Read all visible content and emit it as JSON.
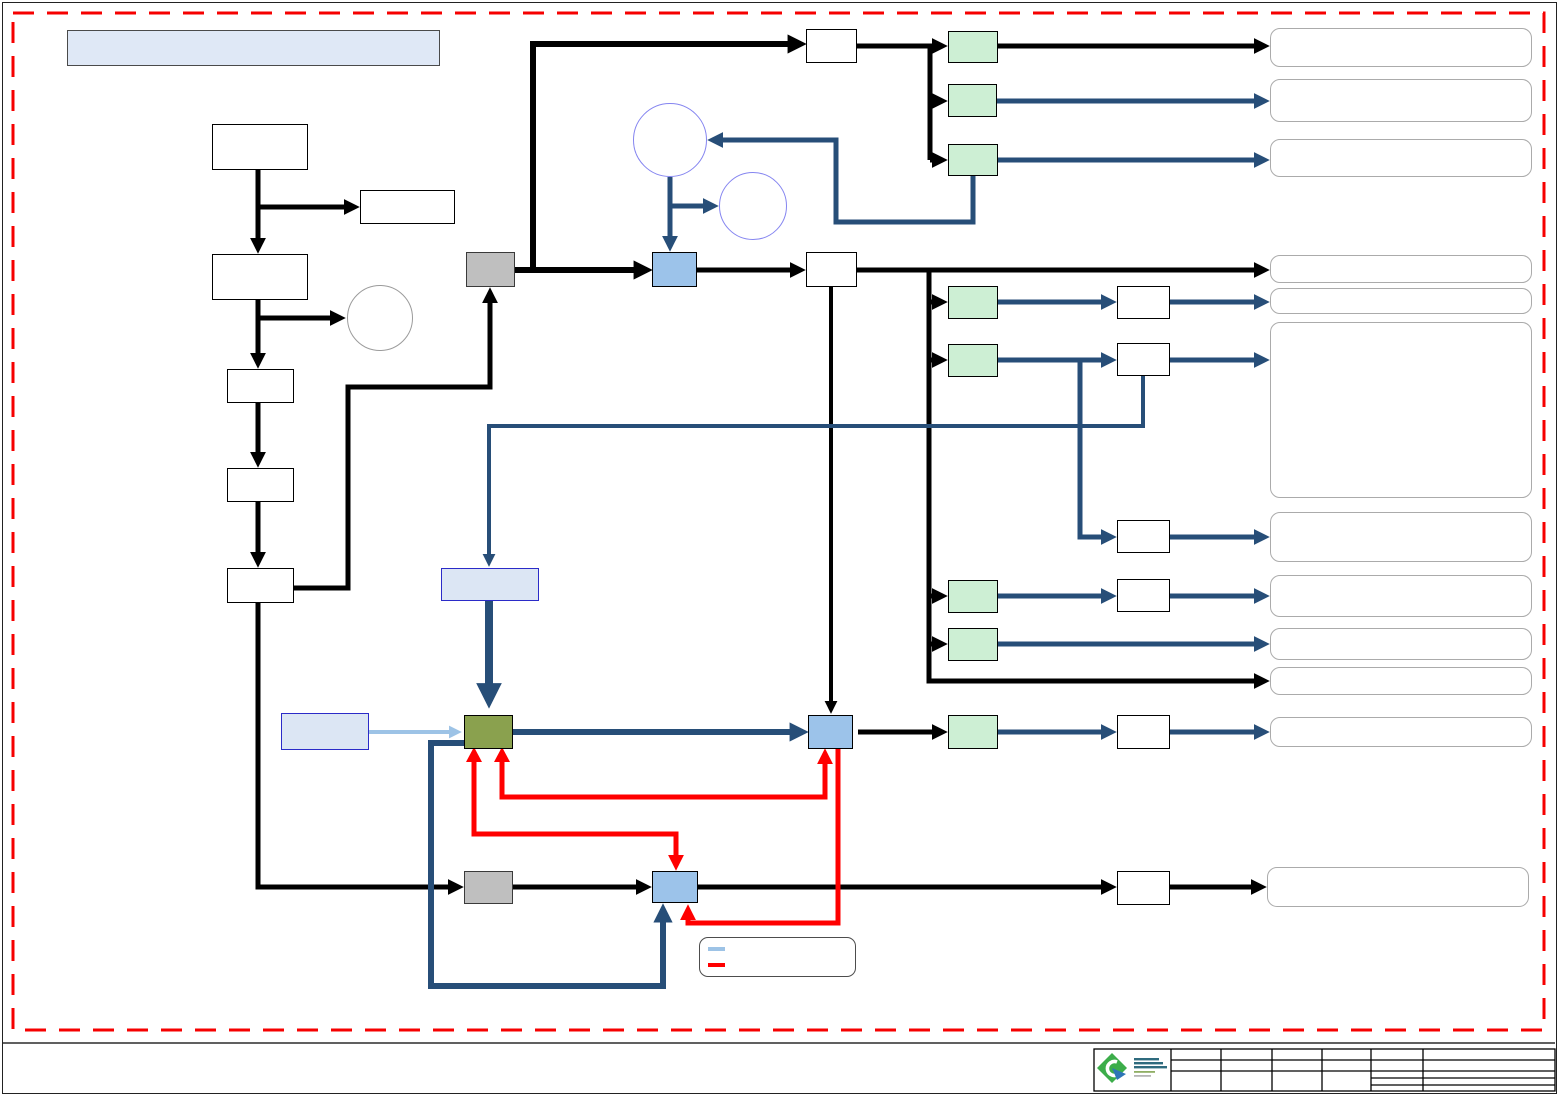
{
  "page": {
    "background": "#FFFFFF",
    "frame_color": "#222222",
    "boundary": {
      "style": "dashed",
      "color": "#FF0000"
    }
  },
  "header_box": {
    "label": ""
  },
  "colors": {
    "black_connector": "#000000",
    "navy_connector": "#274E78",
    "red_connector": "#FF0000",
    "light_blue_connector": "#9DC3E6",
    "green_fill": "#CDEFD4",
    "blue_fill": "#9CC3EA",
    "olive_fill": "#8AA14E",
    "gray_fill": "#BFBFBF",
    "panel_fill": "#DCE6F4",
    "panel_border": "#2B2BC8",
    "rounded_box_border": "#ABABAB",
    "circle_border_blue": "#8585F0",
    "circle_border_gray": "#9B9B9B",
    "logo_green": "#3CAD4A",
    "logo_blue": "#2E75B6"
  },
  "legend": {
    "items": [
      {
        "swatch_color": "#9DC3E6",
        "label": ""
      },
      {
        "swatch_color": "#FF0000",
        "label": ""
      }
    ]
  },
  "nodes": {
    "header_box": {
      "shape": "rect",
      "fill": "#DFE8F6",
      "label": ""
    },
    "flow_box_1": {
      "shape": "rect",
      "fill": "#FFFFFF",
      "label": ""
    },
    "flow_side_box": {
      "shape": "rect",
      "fill": "#FFFFFF",
      "label": ""
    },
    "flow_box_2": {
      "shape": "rect",
      "fill": "#FFFFFF",
      "label": ""
    },
    "flow_box_3": {
      "shape": "rect",
      "fill": "#FFFFFF",
      "label": ""
    },
    "flow_box_4": {
      "shape": "rect",
      "fill": "#FFFFFF",
      "label": ""
    },
    "flow_box_5": {
      "shape": "rect",
      "fill": "#FFFFFF",
      "label": ""
    },
    "side_circle": {
      "shape": "circle",
      "label": ""
    },
    "circle_upper": {
      "shape": "circle",
      "label": ""
    },
    "circle_lower": {
      "shape": "circle",
      "label": ""
    },
    "gray_box_top": {
      "shape": "rect",
      "fill": "#BFBFBF",
      "label": ""
    },
    "gray_box_bottom": {
      "shape": "rect",
      "fill": "#BFBFBF",
      "label": ""
    },
    "blue_box_1": {
      "shape": "rect",
      "fill": "#9CC3EA",
      "label": ""
    },
    "blue_box_2": {
      "shape": "rect",
      "fill": "#9CC3EA",
      "label": ""
    },
    "blue_box_3": {
      "shape": "rect",
      "fill": "#9CC3EA",
      "label": ""
    },
    "olive_box": {
      "shape": "rect",
      "fill": "#8AA14E",
      "label": ""
    },
    "panel_box_upper": {
      "shape": "rect",
      "fill": "#DCE6F4",
      "label": ""
    },
    "panel_box_left": {
      "shape": "rect",
      "fill": "#DCE6F4",
      "label": ""
    },
    "white_relay_1": {
      "label": ""
    },
    "white_relay_2": {
      "label": ""
    },
    "white_relay_3": {
      "label": ""
    },
    "white_relay_4": {
      "label": ""
    },
    "white_relay_5": {
      "label": ""
    },
    "white_relay_6": {
      "label": ""
    },
    "white_relay_7": {
      "label": ""
    },
    "white_relay_8": {
      "label": ""
    },
    "green_box_1": {
      "label": ""
    },
    "green_box_2": {
      "label": ""
    },
    "green_box_3": {
      "label": ""
    },
    "green_box_4": {
      "label": ""
    },
    "green_box_5": {
      "label": ""
    },
    "green_box_6": {
      "label": ""
    },
    "green_box_7": {
      "label": ""
    },
    "green_box_8": {
      "label": ""
    },
    "rounded_output_1": {
      "label": ""
    },
    "rounded_output_2": {
      "label": ""
    },
    "rounded_output_3": {
      "label": ""
    },
    "rounded_output_4": {
      "label": ""
    },
    "rounded_output_5": {
      "label": ""
    },
    "rounded_output_tall": {
      "label": ""
    },
    "rounded_output_6": {
      "label": ""
    },
    "rounded_output_7": {
      "label": ""
    },
    "rounded_output_8": {
      "label": ""
    },
    "rounded_output_9": {
      "label": ""
    },
    "rounded_output_10": {
      "label": ""
    },
    "rounded_output_11": {
      "label": ""
    }
  },
  "title_block": {
    "logo": "green-diamond-chevron-logo",
    "rows": 4,
    "columns": 6,
    "cells": [
      "",
      "",
      "",
      "",
      "",
      "",
      "",
      "",
      "",
      "",
      "",
      ""
    ]
  }
}
